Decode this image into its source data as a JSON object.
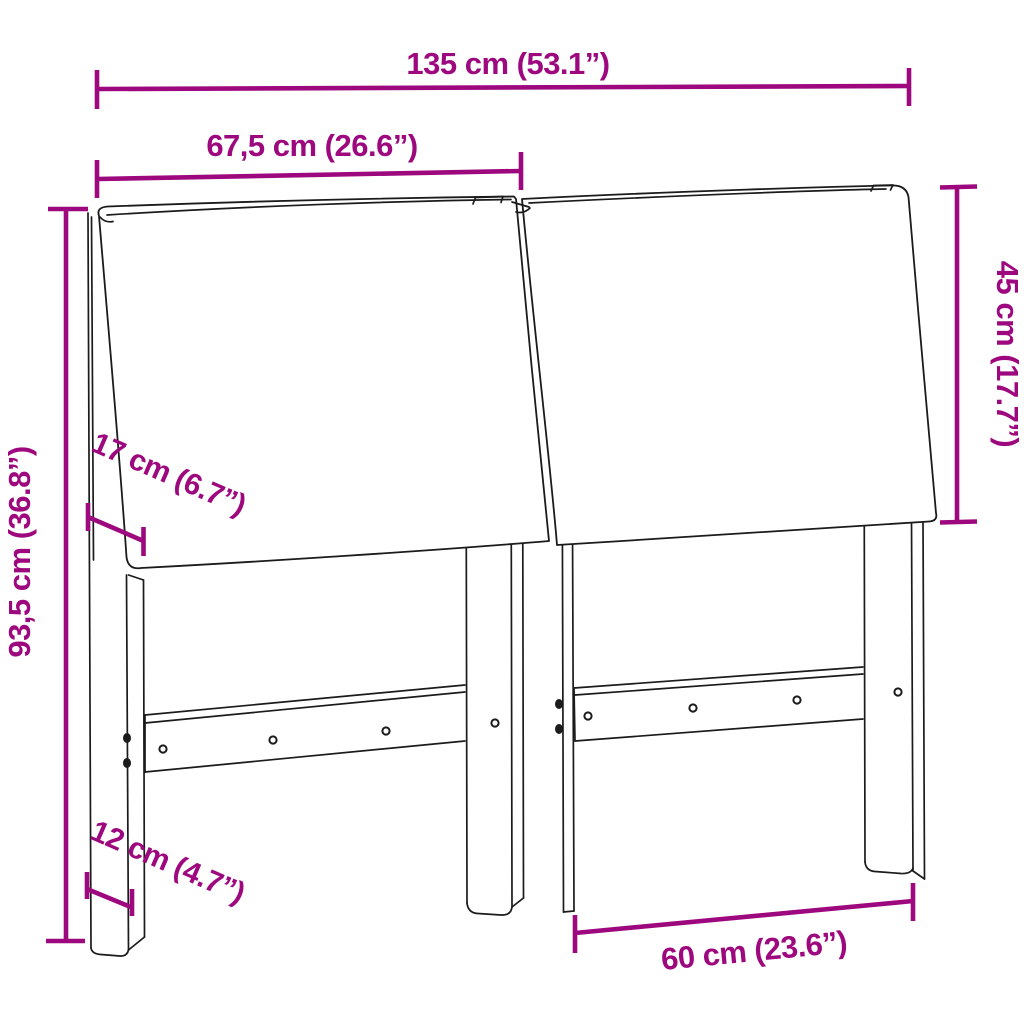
{
  "figure": {
    "subject": "headboard-with-cushions-dimension-diagram",
    "background_color": "#ffffff",
    "accent_color": "#9E087E",
    "line_color": "#1b1b1b",
    "labels": {
      "total_width": "135 cm (53.1”)",
      "half_width": "67,5 cm (26.6”)",
      "cushion_height": "45 cm (17.7”)",
      "total_height": "93,5 cm (36.8”)",
      "cushion_depth": "17 cm (6.7”)",
      "leg_depth": "12 cm (4.7”)",
      "leg_span": "60 cm (23.6”)"
    }
  }
}
